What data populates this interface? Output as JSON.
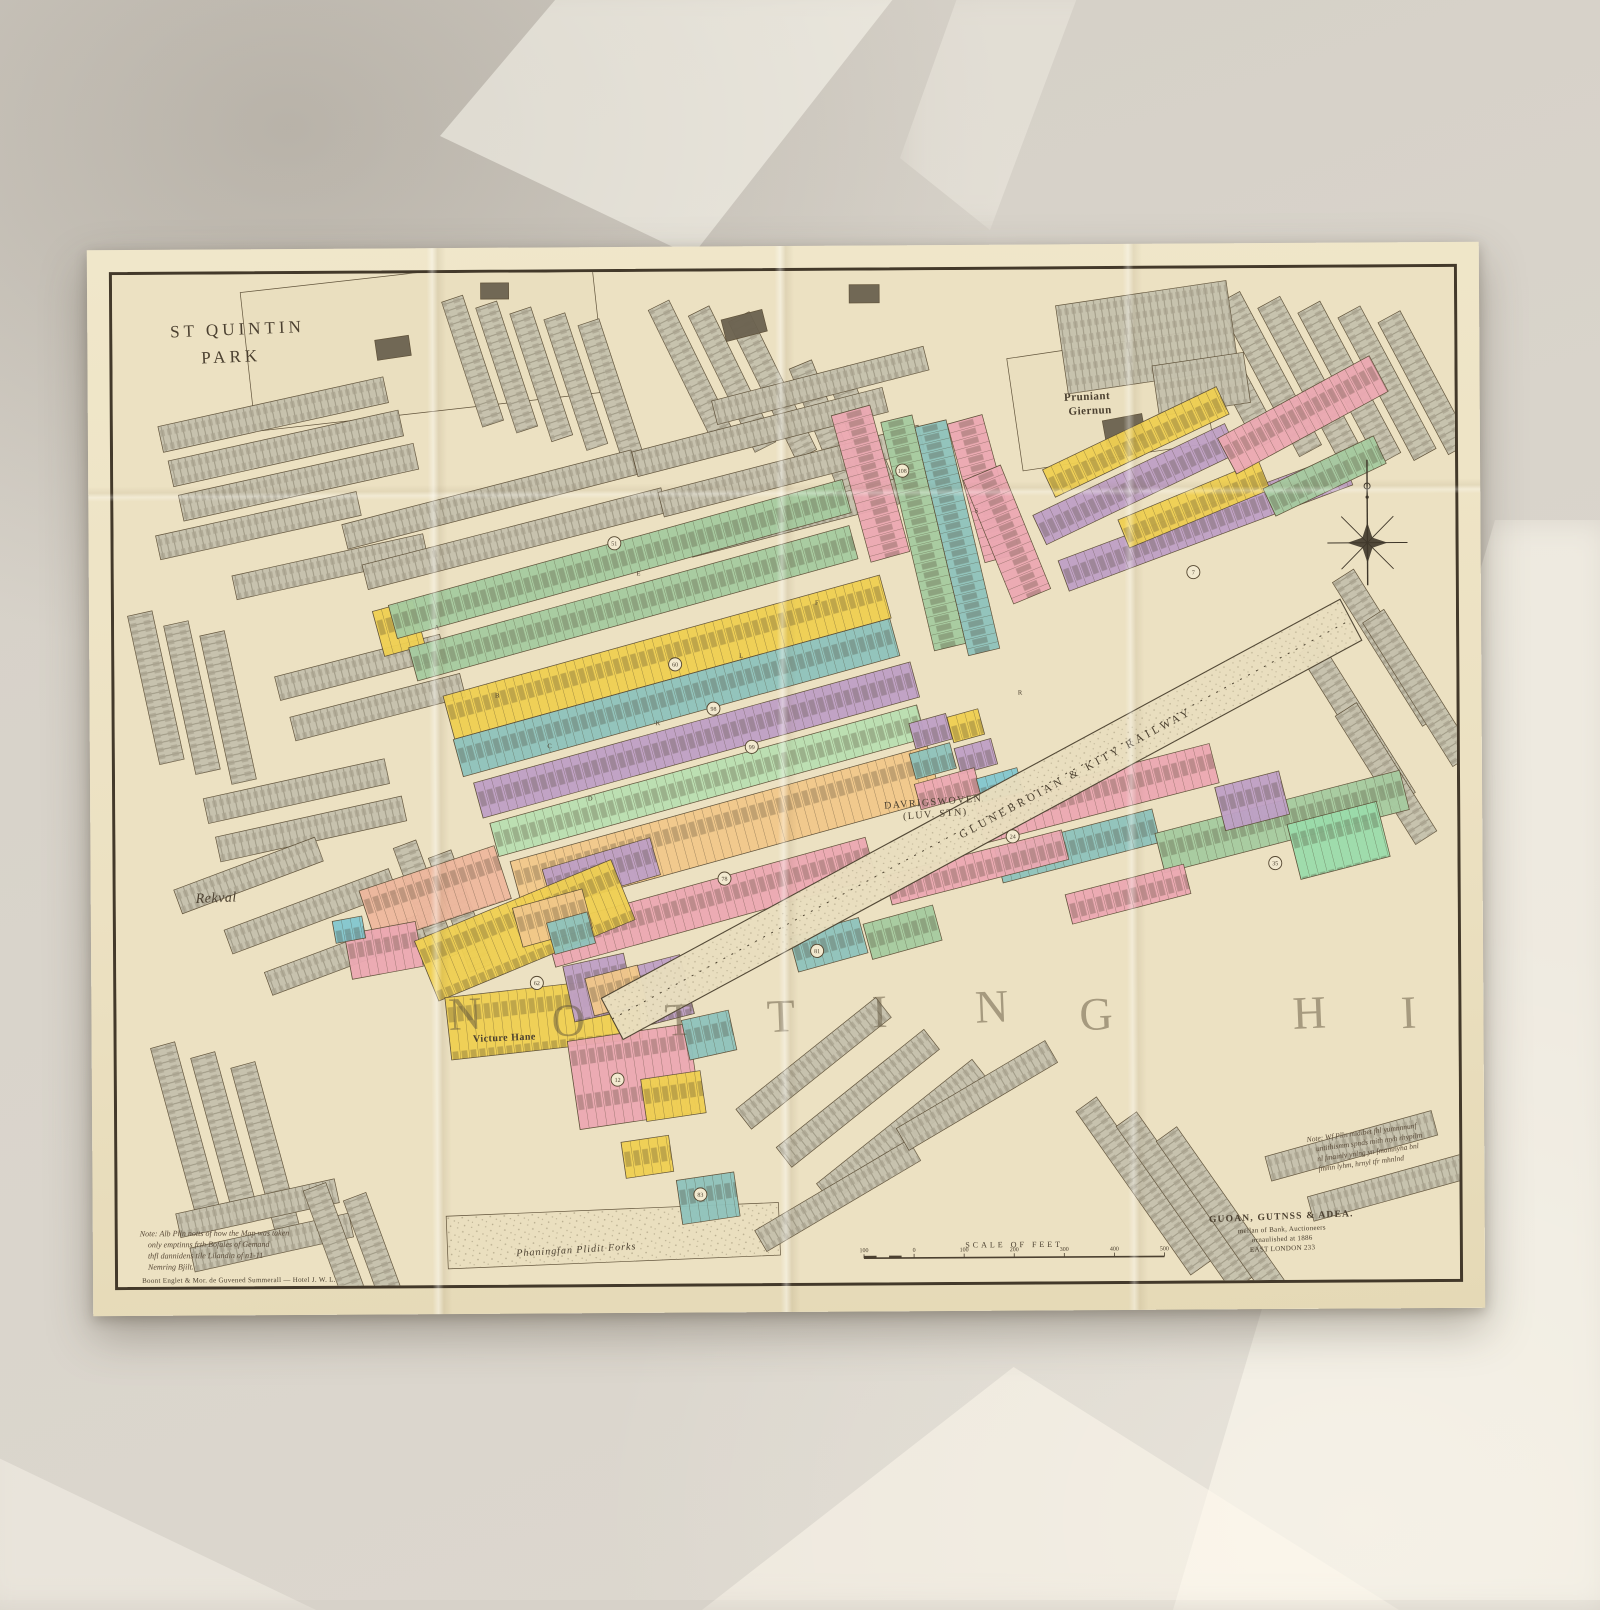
{
  "scene": {
    "wall_color": "#d7d2c9",
    "sheet_color": "#ece1c2",
    "frame_color": "#43392a"
  },
  "map": {
    "palette": {
      "P": "#eadfbf",
      "G": "#c6c1ad",
      "D": "#6b6250",
      "g": "#a6cba0",
      "m": "#badfb2",
      "M": "#9bdcab",
      "t": "#8fc3bc",
      "c": "#83c7cf",
      "y": "#f0d052",
      "p": "#bfa0c6",
      "k": "#eca9b3",
      "s": "#efb89e",
      "o": "#f2c88b",
      "ink": "#4b4030"
    },
    "strips": [
      [
        128,
        18,
        352,
        138,
        -6,
        "P",
        "n"
      ],
      [
        893,
        88,
        192,
        112,
        -8,
        "P",
        "n"
      ],
      [
        328,
        932,
        332,
        52,
        -2,
        "P",
        "s"
      ],
      [
        45,
        150,
        230,
        26,
        -12,
        "G",
        "h"
      ],
      [
        55,
        184,
        235,
        26,
        -12,
        "G",
        "h"
      ],
      [
        65,
        218,
        240,
        26,
        -12,
        "G",
        "h"
      ],
      [
        42,
        258,
        205,
        24,
        -12,
        "G",
        "h"
      ],
      [
        118,
        298,
        195,
        24,
        -12,
        "G",
        "h"
      ],
      [
        38,
        332,
        150,
        25,
        78,
        "G",
        "h"
      ],
      [
        74,
        342,
        150,
        25,
        78,
        "G",
        "h"
      ],
      [
        110,
        352,
        150,
        25,
        78,
        "G",
        "h"
      ],
      [
        160,
        398,
        170,
        24,
        -14,
        "G",
        "h"
      ],
      [
        175,
        438,
        175,
        24,
        -14,
        "G",
        "h"
      ],
      [
        88,
        518,
        185,
        25,
        -12,
        "G",
        "h"
      ],
      [
        100,
        556,
        190,
        25,
        -12,
        "G",
        "h"
      ],
      [
        58,
        608,
        150,
        25,
        -20,
        "G",
        "h"
      ],
      [
        108,
        648,
        175,
        25,
        -20,
        "G",
        "h"
      ],
      [
        148,
        690,
        185,
        24,
        -20,
        "G",
        "h"
      ],
      [
        300,
        560,
        120,
        24,
        70,
        "G",
        "h"
      ],
      [
        335,
        570,
        120,
        24,
        70,
        "G",
        "h"
      ],
      [
        350,
        22,
        130,
        22,
        72,
        "G",
        "h"
      ],
      [
        384,
        28,
        130,
        22,
        72,
        "G",
        "h"
      ],
      [
        418,
        34,
        133,
        22,
        72,
        "G",
        "h"
      ],
      [
        452,
        40,
        136,
        22,
        72,
        "G",
        "h"
      ],
      [
        486,
        46,
        138,
        22,
        72,
        "G",
        "h"
      ],
      [
        556,
        28,
        148,
        23,
        64,
        "G",
        "h"
      ],
      [
        596,
        34,
        150,
        23,
        64,
        "G",
        "h"
      ],
      [
        636,
        40,
        152,
        23,
        64,
        "G",
        "h"
      ],
      [
        698,
        88,
        140,
        24,
        68,
        "G",
        "h"
      ],
      [
        734,
        94,
        140,
        24,
        68,
        "G",
        "h"
      ],
      [
        1086,
        18,
        168,
        25,
        62,
        "G",
        "h"
      ],
      [
        1126,
        23,
        172,
        25,
        62,
        "G",
        "h"
      ],
      [
        1166,
        28,
        174,
        25,
        62,
        "G",
        "h"
      ],
      [
        1206,
        33,
        170,
        25,
        62,
        "G",
        "h"
      ],
      [
        1246,
        38,
        160,
        25,
        62,
        "G",
        "h"
      ],
      [
        1286,
        43,
        148,
        25,
        62,
        "G",
        "h"
      ],
      [
        942,
        36,
        172,
        88,
        -8,
        "G",
        "h"
      ],
      [
        1038,
        96,
        92,
        50,
        -8,
        "G",
        "h"
      ],
      [
        1238,
        298,
        168,
        25,
        58,
        "G",
        "h"
      ],
      [
        1268,
        338,
        168,
        25,
        58,
        "G",
        "h"
      ],
      [
        1204,
        368,
        178,
        25,
        58,
        "G",
        "h"
      ],
      [
        1240,
        430,
        150,
        25,
        58,
        "G",
        "h"
      ],
      [
        228,
        248,
        298,
        25,
        -14,
        "G",
        "h"
      ],
      [
        248,
        288,
        308,
        25,
        -14,
        "G",
        "h"
      ],
      [
        518,
        178,
        258,
        25,
        -14,
        "G",
        "h"
      ],
      [
        544,
        218,
        268,
        25,
        -14,
        "G",
        "h"
      ],
      [
        572,
        258,
        278,
        25,
        -14,
        "G",
        "h"
      ],
      [
        598,
        128,
        218,
        24,
        -14,
        "G",
        "h"
      ],
      [
        58,
        758,
        168,
        25,
        75,
        "G",
        "h"
      ],
      [
        98,
        768,
        170,
        25,
        75,
        "G",
        "h"
      ],
      [
        138,
        778,
        172,
        25,
        75,
        "G",
        "h"
      ],
      [
        58,
        928,
        162,
        24,
        -12,
        "G",
        "h"
      ],
      [
        72,
        962,
        162,
        24,
        -12,
        "G",
        "h"
      ],
      [
        208,
        898,
        162,
        24,
        70,
        "G",
        "h"
      ],
      [
        248,
        908,
        165,
        24,
        70,
        "G",
        "h"
      ],
      [
        618,
        828,
        178,
        25,
        -38,
        "G",
        "h"
      ],
      [
        658,
        866,
        188,
        25,
        -38,
        "G",
        "h"
      ],
      [
        698,
        902,
        198,
        25,
        -38,
        "G",
        "h"
      ],
      [
        636,
        948,
        178,
        24,
        -30,
        "G",
        "h"
      ],
      [
        778,
        848,
        172,
        25,
        -30,
        "G",
        "h"
      ],
      [
        978,
        818,
        198,
        25,
        55,
        "G",
        "h"
      ],
      [
        1018,
        833,
        200,
        25,
        55,
        "G",
        "h"
      ],
      [
        1058,
        848,
        200,
        25,
        55,
        "G",
        "h"
      ],
      [
        1146,
        878,
        172,
        25,
        -15,
        "G",
        "h"
      ],
      [
        1188,
        918,
        172,
        25,
        -15,
        "G",
        "h"
      ],
      [
        368,
        10,
        28,
        16,
        0,
        "D",
        "n"
      ],
      [
        608,
        48,
        42,
        22,
        -14,
        "D",
        "n"
      ],
      [
        736,
        14,
        30,
        18,
        0,
        "D",
        "n"
      ],
      [
        988,
        150,
        40,
        26,
        -10,
        "D",
        "n"
      ],
      [
        262,
        66,
        34,
        20,
        -8,
        "D",
        "n"
      ],
      [
        258,
        334,
        42,
        46,
        -15,
        "y",
        "p"
      ],
      [
        274,
        328,
        470,
        34,
        -15,
        "g",
        "p"
      ],
      [
        294,
        370,
        456,
        34,
        -15,
        "g",
        "p"
      ],
      [
        328,
        418,
        452,
        44,
        -15,
        "y",
        "p"
      ],
      [
        338,
        461,
        452,
        38,
        -15,
        "t",
        "p"
      ],
      [
        358,
        504,
        452,
        36,
        -15,
        "p",
        "p"
      ],
      [
        374,
        544,
        442,
        34,
        -15,
        "m",
        "p"
      ],
      [
        394,
        582,
        432,
        54,
        -15,
        "o",
        "p"
      ],
      [
        428,
        646,
        332,
        42,
        -15,
        "k",
        "p"
      ],
      [
        672,
        658,
        72,
        36,
        -15,
        "t",
        "p"
      ],
      [
        746,
        646,
        72,
        36,
        -15,
        "g",
        "p"
      ],
      [
        756,
        133,
        150,
        40,
        75,
        "k",
        "p"
      ],
      [
        798,
        143,
        232,
        32,
        77,
        "g",
        "p"
      ],
      [
        832,
        148,
        232,
        32,
        77,
        "t",
        "p"
      ],
      [
        868,
        143,
        142,
        36,
        75,
        "k",
        "p"
      ],
      [
        886,
        193,
        132,
        40,
        68,
        "k",
        "p"
      ],
      [
        928,
        198,
        192,
        30,
        -25,
        "y",
        "p"
      ],
      [
        918,
        243,
        212,
        32,
        -25,
        "p",
        "p"
      ],
      [
        943,
        288,
        302,
        32,
        -20,
        "p",
        "p"
      ],
      [
        1003,
        248,
        152,
        30,
        -22,
        "y",
        "p"
      ],
      [
        1103,
        168,
        172,
        40,
        -28,
        "k",
        "p"
      ],
      [
        1148,
        218,
        122,
        30,
        -25,
        "g",
        "p"
      ],
      [
        793,
        448,
        38,
        26,
        -15,
        "p",
        "p"
      ],
      [
        831,
        442,
        32,
        26,
        -15,
        "y",
        "p"
      ],
      [
        793,
        478,
        42,
        26,
        -15,
        "t",
        "p"
      ],
      [
        838,
        473,
        38,
        26,
        -15,
        "p",
        "p"
      ],
      [
        798,
        508,
        62,
        26,
        -15,
        "k",
        "p"
      ],
      [
        860,
        503,
        42,
        26,
        -15,
        "c",
        "p"
      ],
      [
        858,
        528,
        242,
        40,
        -14,
        "k",
        "p"
      ],
      [
        878,
        573,
        162,
        34,
        -14,
        "t",
        "p"
      ],
      [
        1038,
        558,
        252,
        40,
        -14,
        "g",
        "p"
      ],
      [
        1170,
        550,
        92,
        56,
        -14,
        "M",
        "p"
      ],
      [
        1098,
        513,
        66,
        44,
        -14,
        "p",
        "p"
      ],
      [
        768,
        598,
        182,
        30,
        -14,
        "k",
        "p"
      ],
      [
        948,
        618,
        122,
        30,
        -14,
        "k",
        "p"
      ],
      [
        243,
        610,
        142,
        55,
        -18,
        "s",
        "p"
      ],
      [
        228,
        653,
        72,
        45,
        -10,
        "k",
        "p"
      ],
      [
        216,
        640,
        30,
        22,
        -10,
        "c",
        "p"
      ],
      [
        426,
        590,
        112,
        38,
        -16,
        "p",
        "p"
      ],
      [
        298,
        660,
        212,
        64,
        -22,
        "y",
        "p"
      ],
      [
        328,
        716,
        192,
        62,
        -6,
        "y",
        "p"
      ],
      [
        396,
        628,
        72,
        40,
        -15,
        "o",
        "p"
      ],
      [
        430,
        643,
        42,
        32,
        -15,
        "t",
        "p"
      ],
      [
        446,
        686,
        62,
        56,
        -12,
        "p",
        "p"
      ],
      [
        518,
        686,
        46,
        60,
        -14,
        "p",
        "p"
      ],
      [
        468,
        698,
        54,
        38,
        -14,
        "o",
        "p"
      ],
      [
        450,
        760,
        122,
        88,
        -8,
        "k",
        "p"
      ],
      [
        523,
        798,
        60,
        42,
        -8,
        "y",
        "p"
      ],
      [
        564,
        740,
        48,
        40,
        -12,
        "t",
        "p"
      ],
      [
        558,
        898,
        58,
        44,
        -8,
        "t",
        "p"
      ],
      [
        503,
        860,
        48,
        36,
        -8,
        "y",
        "p"
      ]
    ],
    "railway": {
      "x1": 495,
      "y1": 738,
      "x2": 1235,
      "y2": 348,
      "width": 46,
      "label": "GLUNEBROIAN & KITY RAILWAY",
      "label_x": 845,
      "label_y": 562,
      "label_angle": -27.8
    },
    "labels": [
      {
        "id": "st-quintin-park",
        "lines": [
          "ST QUINTIN",
          "PARK"
        ],
        "x": 58,
        "y": 62,
        "dy": 27,
        "dx2": 30,
        "size": 17,
        "ls": 4,
        "angle": -2,
        "cls": "mt"
      },
      {
        "id": "pruniant-giernun",
        "lines": [
          "Pruniant",
          "Giernun"
        ],
        "x": 950,
        "y": 130,
        "dy": 14,
        "dx2": 4,
        "size": 11,
        "ls": 0.5,
        "angle": -2,
        "cls": "mt bd"
      },
      {
        "id": "rekval",
        "lines": [
          "Rekval"
        ],
        "x": 80,
        "y": 621,
        "dy": 0,
        "dx2": 0,
        "size": 14,
        "ls": 0.5,
        "angle": -2,
        "cls": "mt it"
      },
      {
        "id": "victure-hane",
        "lines": [
          "Victure Hane"
        ],
        "x": 356,
        "y": 760,
        "dy": 0,
        "dx2": 0,
        "size": 10,
        "ls": 0.5,
        "angle": -2,
        "cls": "mt bd"
      },
      {
        "id": "station",
        "lines": [
          "DAVRIGSWOVEN",
          "(LUV. STN)"
        ],
        "x": 768,
        "y": 532,
        "dy": 12,
        "dx2": 18,
        "size": 10,
        "ls": 1.5,
        "angle": -4,
        "cls": "mt"
      },
      {
        "id": "park-recreation",
        "lines": [
          "Phaningfan Plidit Forks"
        ],
        "x": 398,
        "y": 972,
        "dy": 0,
        "dx2": 0,
        "size": 10,
        "ls": 1,
        "angle": -3,
        "cls": "mt it"
      }
    ],
    "notes": [
      {
        "id": "note-bottom-left",
        "x": 22,
        "y": 950,
        "dy": 11,
        "size": 8,
        "angle": 0,
        "lines": [
          "Note: Alb Plln notts of how the Map was taken",
          "only emptinns frth Bofales of Gemand",
          "thfl dannidens tile Lilandin of n1-11",
          "Nemring Bjilt."
        ]
      },
      {
        "id": "note-bottom-right",
        "x": 1188,
        "y": 864,
        "dy": 10,
        "size": 7.5,
        "angle": -7,
        "lines": [
          "Note: Wf Plln midibet fhl yumnnnunf",
          "untithismm spnds mith myh rhypilm",
          "nl fmainly ynlng yn fmamnyha bnl",
          "fmmn lyhm, hrnyl tfr mhnlnd"
        ]
      }
    ],
    "imprints": [
      {
        "id": "publisher-imprint",
        "x": 1162,
        "y": 940,
        "dy": 10,
        "angle": -2,
        "align": "middle",
        "lines": [
          {
            "t": "GUOAN, GUTNSS & ADEA.",
            "s": 9.5,
            "b": true
          },
          {
            "t": "mellan of Bank, Auctioneers",
            "s": 7,
            "b": false
          },
          {
            "t": "ornaulished at 1886",
            "s": 7,
            "b": false
          },
          {
            "t": "EAST LONDON 233",
            "s": 7,
            "b": false
          }
        ]
      },
      {
        "id": "engraver-imprint",
        "x": 24,
        "y": 996,
        "dy": 0,
        "angle": 0,
        "align": "start",
        "lines": [
          {
            "t": "Boont Englet & Mor. de Guvened Summerall — Hotel J. W. L.",
            "s": 7,
            "b": false
          }
        ]
      }
    ],
    "scalebar": {
      "x": 745,
      "y": 976,
      "w": 300,
      "title": "SCALE OF FEET",
      "tick_labels": [
        "100",
        "0",
        "100",
        "200",
        "300",
        "400",
        "500"
      ]
    },
    "compass": {
      "x": 1252,
      "y": 272
    },
    "badges": [
      [
        500,
        268,
        "51"
      ],
      [
        560,
        388,
        "60"
      ],
      [
        598,
        432,
        "98"
      ],
      [
        636,
        470,
        "99"
      ],
      [
        608,
        600,
        "78"
      ],
      [
        500,
        798,
        "12"
      ],
      [
        1158,
        588,
        "35"
      ],
      [
        1078,
        300,
        "7"
      ],
      [
        788,
        198,
        "108"
      ],
      [
        420,
        702,
        "62"
      ],
      [
        582,
        912,
        "83"
      ],
      [
        896,
        560,
        "24"
      ],
      [
        700,
        672,
        "81"
      ]
    ],
    "ghost_text": "NOTTING HI",
    "ghost_letters": [
      [
        332,
        748,
        "N"
      ],
      [
        435,
        755,
        "O"
      ],
      [
        548,
        755,
        "T"
      ],
      [
        650,
        752,
        "T"
      ],
      [
        755,
        748,
        "I"
      ],
      [
        858,
        744,
        "N"
      ],
      [
        962,
        752,
        "G"
      ],
      [
        1175,
        752,
        "H"
      ],
      [
        1283,
        752,
        "I"
      ]
    ],
    "street_letters": [
      [
        320,
        352,
        "A"
      ],
      [
        380,
        420,
        "B"
      ],
      [
        432,
        470,
        "C"
      ],
      [
        472,
        522,
        "D"
      ],
      [
        522,
        300,
        "E"
      ],
      [
        700,
        330,
        "F"
      ],
      [
        860,
        240,
        "S"
      ],
      [
        902,
        420,
        "R"
      ],
      [
        624,
        382,
        "L"
      ],
      [
        540,
        448,
        "K"
      ]
    ]
  }
}
